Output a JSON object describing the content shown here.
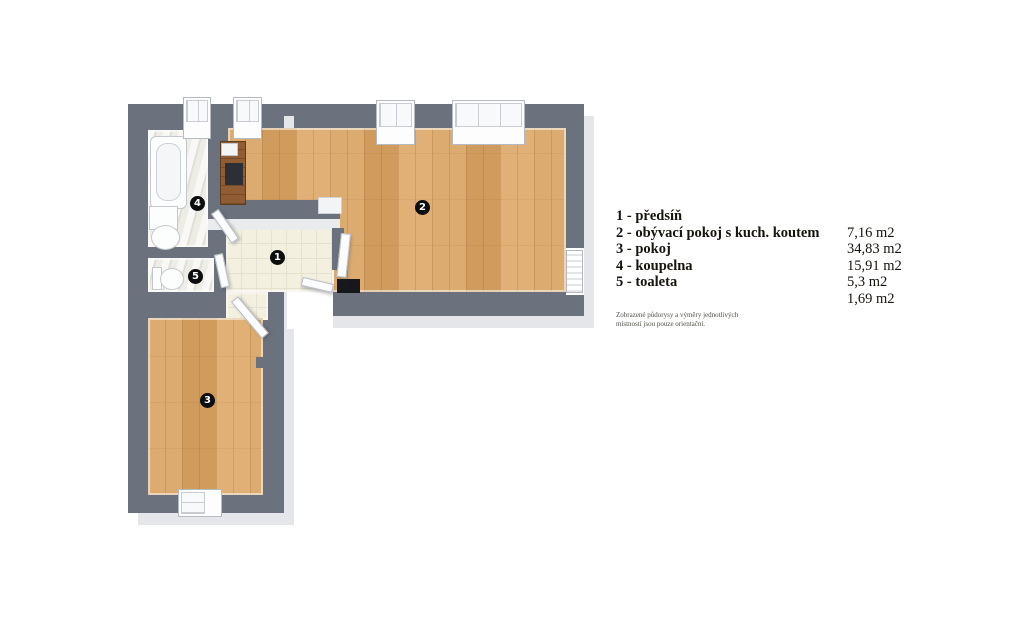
{
  "floorplan": {
    "badges": [
      "1",
      "2",
      "3",
      "4",
      "5"
    ],
    "colors": {
      "wall": "#6c727d",
      "wood_floor": "#d8a76b",
      "tile_floor": "#f4f0e0",
      "marble_floor": "#edece5",
      "slab_edge": "#e4e6ea",
      "kitchen_counter": "#8f5c33",
      "cooktop": "#2c3036",
      "doormat": "#16181c"
    }
  },
  "legend": {
    "rows": [
      {
        "label": "1 - předsíň",
        "area": ""
      },
      {
        "label": "2 - obývací pokoj s kuch. koutem",
        "area": "7,16 m2"
      },
      {
        "label": "3 - pokoj",
        "area": "34,83 m2"
      },
      {
        "label": "4 - koupelna",
        "area": "15,91 m2"
      },
      {
        "label": "5 - toaleta",
        "area": "5,3 m2"
      },
      {
        "label": "",
        "area": "1,69 m2"
      }
    ],
    "disclaimer": {
      "line1": "Zobrazené půdorysy a výměry jednotlivých",
      "line2": "místností jsou pouze orientační."
    }
  }
}
